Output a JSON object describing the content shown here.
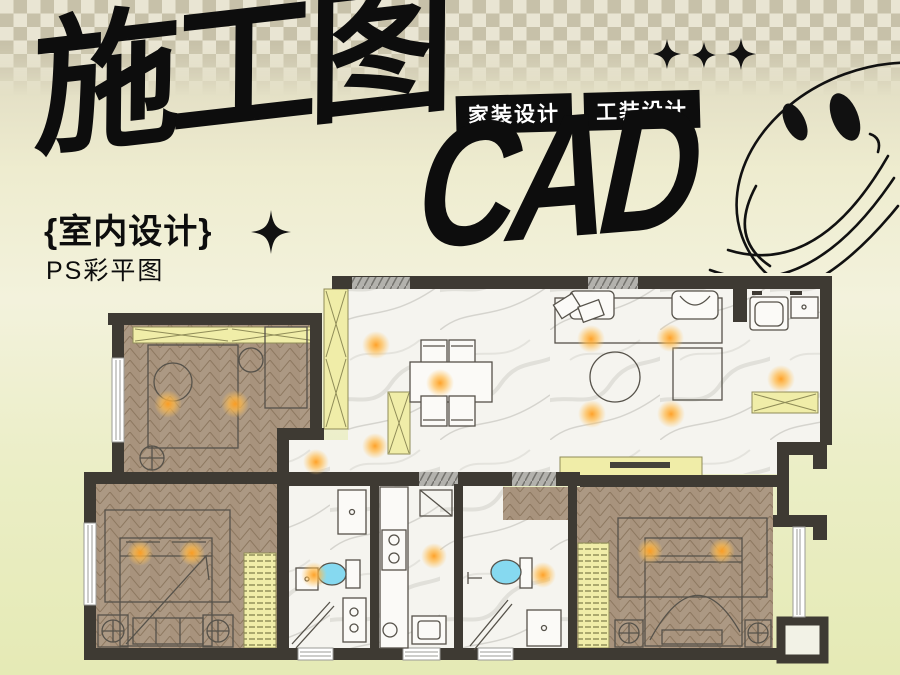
{
  "poster": {
    "title": "施工图",
    "cad_text": "CAD",
    "badges": [
      {
        "label": "家装设计"
      },
      {
        "label": "工装设计"
      }
    ],
    "subtitle": "{室内设计}",
    "caption": "PS彩平图"
  },
  "decor": {
    "sparkle_icon": "four-point-star",
    "sparkle_count": 3,
    "smiley_icon": "smiley-face-outline"
  },
  "floor_plan": {
    "style": "color-rendered CAD plan",
    "elements": [
      "living-dining-room",
      "bedroom-top-left",
      "bedroom-bottom-left",
      "master-bedroom",
      "bathroom-1",
      "bathroom-2",
      "kitchen",
      "utility-corner",
      "balcony",
      "wardrobes",
      "ceiling-lights"
    ],
    "colors": {
      "wall": "#3e3a33",
      "wood_floor": "#a8937d",
      "marble_floor": "#f5f4ef",
      "cabinet_yellow": "#f0eda8",
      "light_glow": "#ffb340",
      "toilet_blue": "#86d9f0",
      "checker_dark": "#c7c1a9",
      "checker_light": "#e9e5d3",
      "ink": "#0d0d0d",
      "badge_text": "#ffffff"
    }
  }
}
